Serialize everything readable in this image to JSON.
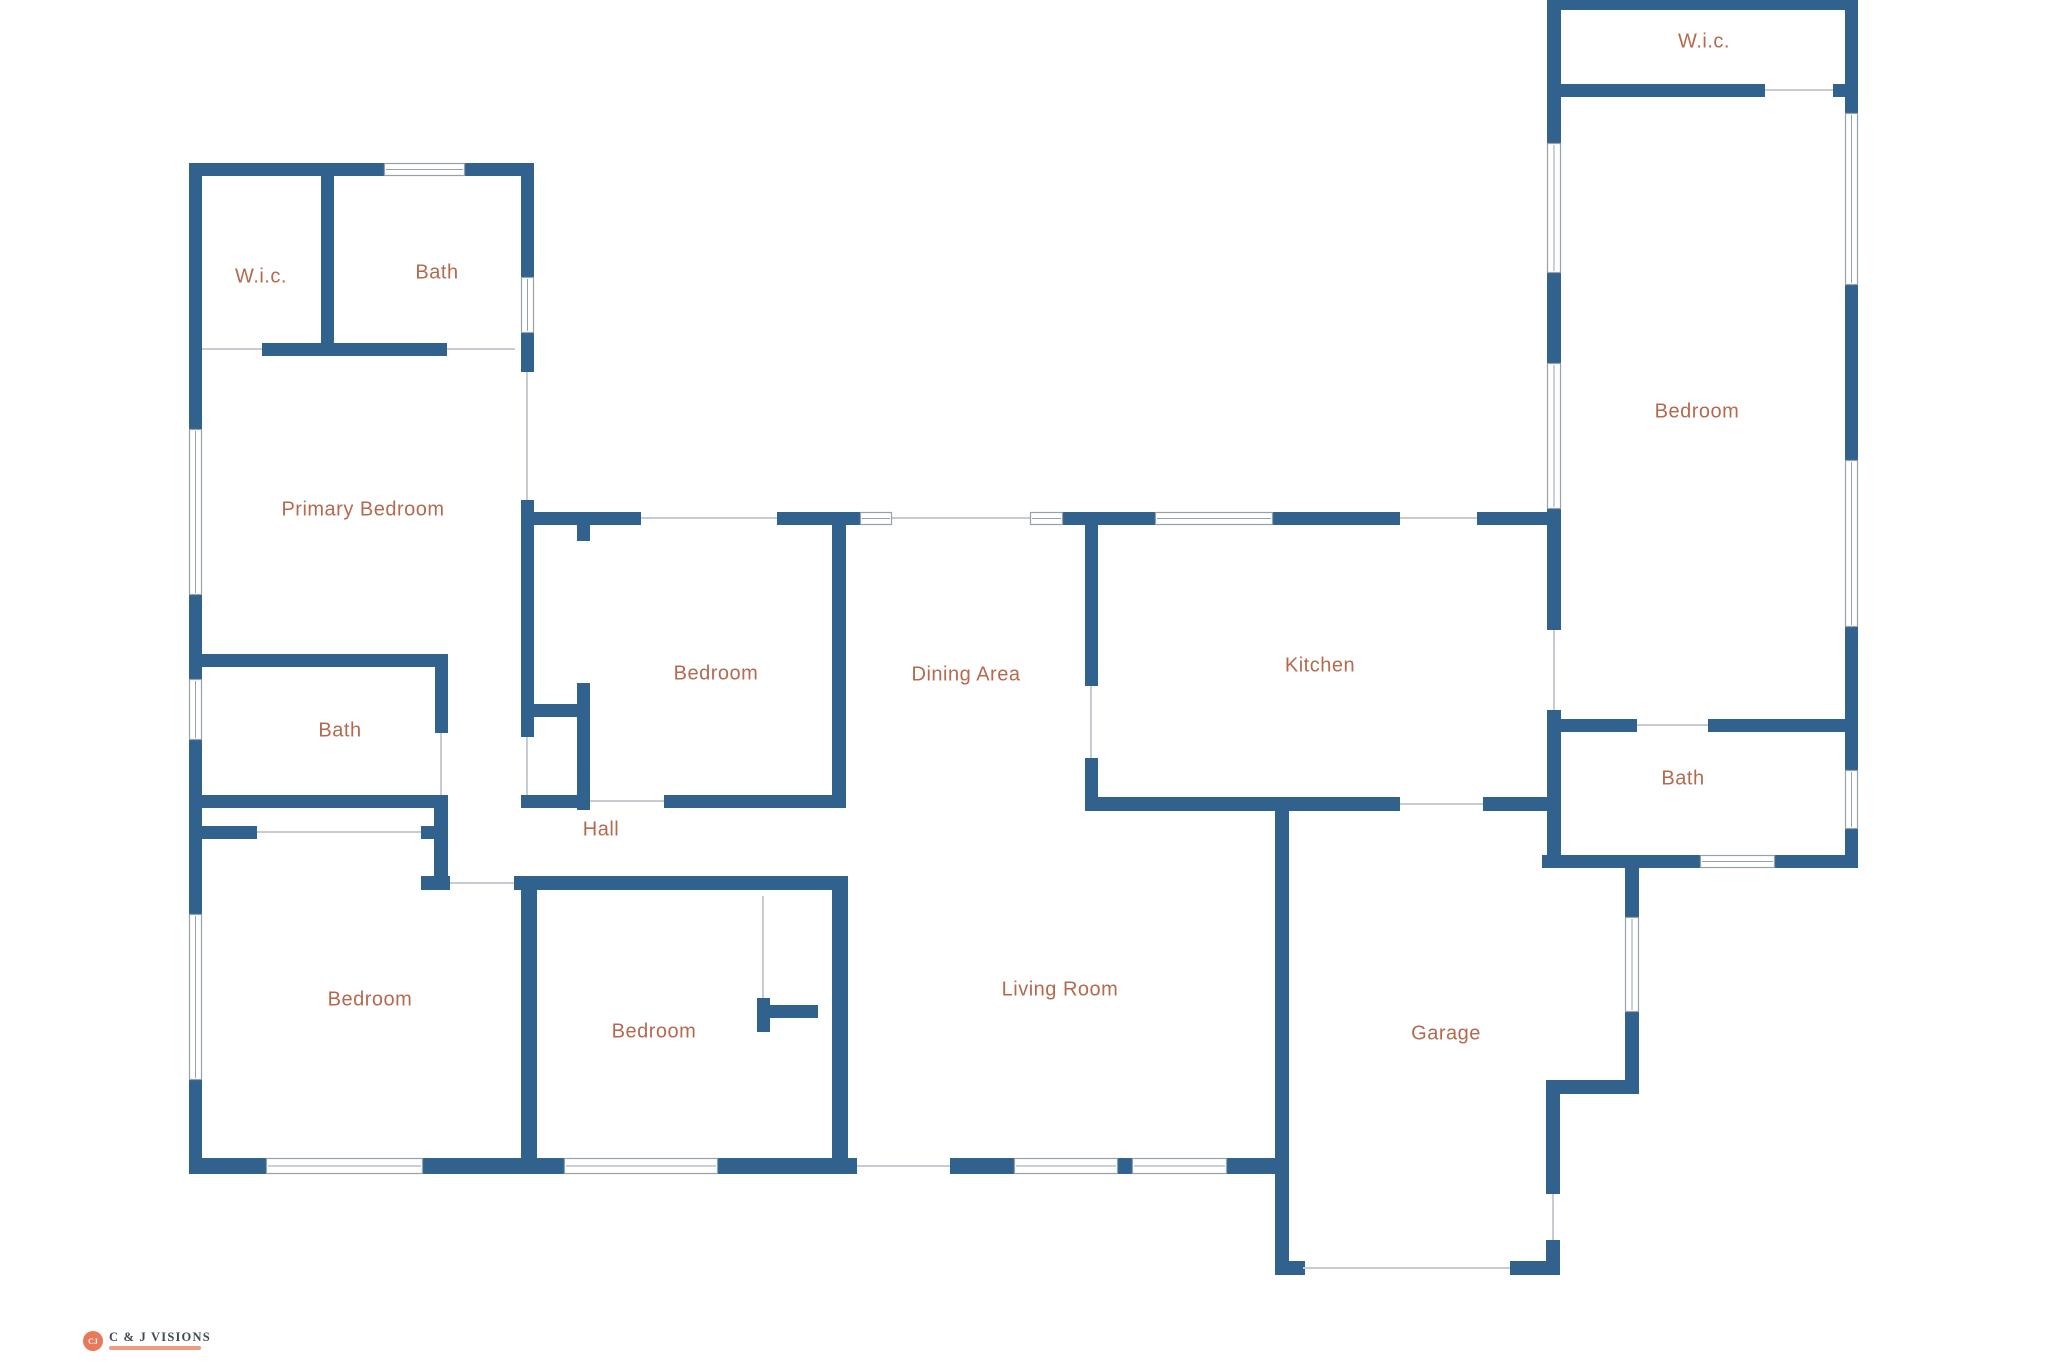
{
  "canvas": {
    "width": 2048,
    "height": 1365
  },
  "palette": {
    "background": "#ffffff",
    "wall": "#30628d",
    "label": "#b5694f",
    "opening_line": "#c6ccd2",
    "window_stroke": "#97a1aa",
    "window_fill": "#ffffff"
  },
  "rooms": [
    {
      "id": "wic-upper-left",
      "label": "W.i.c.",
      "x": 261,
      "y": 277
    },
    {
      "id": "bath-upper-left",
      "label": "Bath",
      "x": 437,
      "y": 273
    },
    {
      "id": "primary-bedroom",
      "label": "Primary Bedroom",
      "x": 363,
      "y": 510
    },
    {
      "id": "bath-left",
      "label": "Bath",
      "x": 340,
      "y": 731
    },
    {
      "id": "hall",
      "label": "Hall",
      "x": 601,
      "y": 830
    },
    {
      "id": "bedroom-mid",
      "label": "Bedroom",
      "x": 716,
      "y": 674
    },
    {
      "id": "dining-area",
      "label": "Dining Area",
      "x": 966,
      "y": 675
    },
    {
      "id": "kitchen",
      "label": "Kitchen",
      "x": 1320,
      "y": 666
    },
    {
      "id": "bedroom-bottom-left",
      "label": "Bedroom",
      "x": 370,
      "y": 1000
    },
    {
      "id": "bedroom-bottom-mid",
      "label": "Bedroom",
      "x": 654,
      "y": 1032
    },
    {
      "id": "living-room",
      "label": "Living Room",
      "x": 1060,
      "y": 990
    },
    {
      "id": "garage",
      "label": "Garage",
      "x": 1446,
      "y": 1034
    },
    {
      "id": "bath-right",
      "label": "Bath",
      "x": 1683,
      "y": 779
    },
    {
      "id": "wic-upper-right",
      "label": "W.i.c.",
      "x": 1704,
      "y": 42
    },
    {
      "id": "bedroom-right",
      "label": "Bedroom",
      "x": 1697,
      "y": 412
    }
  ],
  "walls": [
    {
      "x": 189,
      "y": 163,
      "w": 13,
      "h": 266
    },
    {
      "x": 189,
      "y": 595,
      "w": 13,
      "h": 84
    },
    {
      "x": 189,
      "y": 740,
      "w": 13,
      "h": 174
    },
    {
      "x": 189,
      "y": 1080,
      "w": 13,
      "h": 94
    },
    {
      "x": 189,
      "y": 163,
      "w": 195,
      "h": 13
    },
    {
      "x": 465,
      "y": 163,
      "w": 69,
      "h": 13
    },
    {
      "x": 321,
      "y": 176,
      "w": 13,
      "h": 167
    },
    {
      "x": 262,
      "y": 343,
      "w": 185,
      "h": 13
    },
    {
      "x": 521,
      "y": 176,
      "w": 13,
      "h": 101
    },
    {
      "x": 521,
      "y": 333,
      "w": 13,
      "h": 39
    },
    {
      "x": 521,
      "y": 500,
      "w": 13,
      "h": 237
    },
    {
      "x": 202,
      "y": 654,
      "w": 246,
      "h": 13
    },
    {
      "x": 435,
      "y": 667,
      "w": 13,
      "h": 66
    },
    {
      "x": 202,
      "y": 795,
      "w": 241,
      "h": 13
    },
    {
      "x": 202,
      "y": 826,
      "w": 55,
      "h": 13
    },
    {
      "x": 421,
      "y": 826,
      "w": 26,
      "h": 13
    },
    {
      "x": 434,
      "y": 795,
      "w": 14,
      "h": 81
    },
    {
      "x": 421,
      "y": 876,
      "w": 29,
      "h": 14
    },
    {
      "x": 514,
      "y": 876,
      "w": 30,
      "h": 14
    },
    {
      "x": 521,
      "y": 876,
      "w": 16,
      "h": 298
    },
    {
      "x": 537,
      "y": 876,
      "w": 309,
      "h": 14
    },
    {
      "x": 521,
      "y": 512,
      "w": 120,
      "h": 13
    },
    {
      "x": 777,
      "y": 512,
      "w": 84,
      "h": 13
    },
    {
      "x": 1063,
      "y": 512,
      "w": 92,
      "h": 13
    },
    {
      "x": 1273,
      "y": 512,
      "w": 127,
      "h": 13
    },
    {
      "x": 1477,
      "y": 512,
      "w": 79,
      "h": 13
    },
    {
      "x": 577,
      "y": 525,
      "w": 13,
      "h": 16
    },
    {
      "x": 534,
      "y": 704,
      "w": 43,
      "h": 13
    },
    {
      "x": 577,
      "y": 683,
      "w": 13,
      "h": 127
    },
    {
      "x": 832,
      "y": 525,
      "w": 14,
      "h": 283
    },
    {
      "x": 521,
      "y": 795,
      "w": 69,
      "h": 13
    },
    {
      "x": 664,
      "y": 795,
      "w": 182,
      "h": 13
    },
    {
      "x": 757,
      "y": 998,
      "w": 13,
      "h": 34
    },
    {
      "x": 770,
      "y": 1005,
      "w": 48,
      "h": 13
    },
    {
      "x": 832,
      "y": 876,
      "w": 16,
      "h": 298
    },
    {
      "x": 189,
      "y": 1158,
      "w": 77,
      "h": 16
    },
    {
      "x": 423,
      "y": 1158,
      "w": 141,
      "h": 16
    },
    {
      "x": 718,
      "y": 1158,
      "w": 139,
      "h": 16
    },
    {
      "x": 950,
      "y": 1158,
      "w": 64,
      "h": 16
    },
    {
      "x": 1118,
      "y": 1158,
      "w": 14,
      "h": 16
    },
    {
      "x": 1227,
      "y": 1158,
      "w": 48,
      "h": 16
    },
    {
      "x": 1085,
      "y": 525,
      "w": 13,
      "h": 161
    },
    {
      "x": 1085,
      "y": 758,
      "w": 13,
      "h": 50
    },
    {
      "x": 1085,
      "y": 797,
      "w": 315,
      "h": 14
    },
    {
      "x": 1483,
      "y": 797,
      "w": 73,
      "h": 14
    },
    {
      "x": 1275,
      "y": 810,
      "w": 14,
      "h": 465
    },
    {
      "x": 1289,
      "y": 1261,
      "w": 16,
      "h": 14
    },
    {
      "x": 1625,
      "y": 868,
      "w": 14,
      "h": 49
    },
    {
      "x": 1625,
      "y": 1012,
      "w": 14,
      "h": 82
    },
    {
      "x": 1546,
      "y": 1080,
      "w": 93,
      "h": 14
    },
    {
      "x": 1546,
      "y": 1094,
      "w": 14,
      "h": 100
    },
    {
      "x": 1510,
      "y": 1261,
      "w": 50,
      "h": 14
    },
    {
      "x": 1546,
      "y": 1240,
      "w": 14,
      "h": 21
    },
    {
      "x": 1547,
      "y": 0,
      "w": 311,
      "h": 10
    },
    {
      "x": 1547,
      "y": 0,
      "w": 14,
      "h": 143
    },
    {
      "x": 1547,
      "y": 273,
      "w": 14,
      "h": 90
    },
    {
      "x": 1547,
      "y": 509,
      "w": 14,
      "h": 121
    },
    {
      "x": 1547,
      "y": 710,
      "w": 14,
      "h": 158
    },
    {
      "x": 1547,
      "y": 84,
      "w": 218,
      "h": 13
    },
    {
      "x": 1833,
      "y": 84,
      "w": 25,
      "h": 13
    },
    {
      "x": 1845,
      "y": 0,
      "w": 13,
      "h": 113
    },
    {
      "x": 1845,
      "y": 285,
      "w": 13,
      "h": 175
    },
    {
      "x": 1845,
      "y": 627,
      "w": 13,
      "h": 143
    },
    {
      "x": 1845,
      "y": 829,
      "w": 13,
      "h": 39
    },
    {
      "x": 1561,
      "y": 719,
      "w": 76,
      "h": 13
    },
    {
      "x": 1708,
      "y": 719,
      "w": 140,
      "h": 13
    },
    {
      "x": 1542,
      "y": 855,
      "w": 158,
      "h": 13
    },
    {
      "x": 1775,
      "y": 855,
      "w": 83,
      "h": 13
    }
  ],
  "windows": [
    {
      "x": 189,
      "y": 429,
      "w": 13,
      "h": 166
    },
    {
      "x": 189,
      "y": 679,
      "w": 13,
      "h": 61
    },
    {
      "x": 189,
      "y": 914,
      "w": 13,
      "h": 166
    },
    {
      "x": 384,
      "y": 163,
      "w": 81,
      "h": 13
    },
    {
      "x": 521,
      "y": 277,
      "w": 13,
      "h": 56
    },
    {
      "x": 266,
      "y": 1158,
      "w": 157,
      "h": 16
    },
    {
      "x": 564,
      "y": 1158,
      "w": 154,
      "h": 16
    },
    {
      "x": 1014,
      "y": 1158,
      "w": 104,
      "h": 16
    },
    {
      "x": 1132,
      "y": 1158,
      "w": 95,
      "h": 16
    },
    {
      "x": 860,
      "y": 512,
      "w": 32,
      "h": 13
    },
    {
      "x": 1030,
      "y": 512,
      "w": 33,
      "h": 13
    },
    {
      "x": 1155,
      "y": 512,
      "w": 118,
      "h": 13
    },
    {
      "x": 1700,
      "y": 855,
      "w": 75,
      "h": 13
    },
    {
      "x": 1625,
      "y": 917,
      "w": 14,
      "h": 95
    },
    {
      "x": 1547,
      "y": 143,
      "w": 14,
      "h": 130
    },
    {
      "x": 1547,
      "y": 363,
      "w": 14,
      "h": 146
    },
    {
      "x": 1845,
      "y": 113,
      "w": 13,
      "h": 172
    },
    {
      "x": 1845,
      "y": 460,
      "w": 13,
      "h": 167
    },
    {
      "x": 1845,
      "y": 770,
      "w": 13,
      "h": 59
    }
  ],
  "openings": [
    {
      "x1": 202,
      "y1": 349,
      "x2": 262,
      "y2": 349
    },
    {
      "x1": 447,
      "y1": 349,
      "x2": 515,
      "y2": 349
    },
    {
      "x1": 527,
      "y1": 372,
      "x2": 527,
      "y2": 500
    },
    {
      "x1": 527,
      "y1": 737,
      "x2": 527,
      "y2": 795
    },
    {
      "x1": 441,
      "y1": 733,
      "x2": 441,
      "y2": 795
    },
    {
      "x1": 257,
      "y1": 832,
      "x2": 421,
      "y2": 832
    },
    {
      "x1": 450,
      "y1": 883,
      "x2": 514,
      "y2": 883
    },
    {
      "x1": 590,
      "y1": 801,
      "x2": 664,
      "y2": 801
    },
    {
      "x1": 641,
      "y1": 518,
      "x2": 777,
      "y2": 518
    },
    {
      "x1": 892,
      "y1": 518,
      "x2": 1030,
      "y2": 518
    },
    {
      "x1": 1400,
      "y1": 518,
      "x2": 1477,
      "y2": 518
    },
    {
      "x1": 1091,
      "y1": 686,
      "x2": 1091,
      "y2": 758
    },
    {
      "x1": 1400,
      "y1": 804,
      "x2": 1483,
      "y2": 804
    },
    {
      "x1": 857,
      "y1": 1166,
      "x2": 950,
      "y2": 1166
    },
    {
      "x1": 1554,
      "y1": 630,
      "x2": 1554,
      "y2": 710
    },
    {
      "x1": 1765,
      "y1": 90,
      "x2": 1833,
      "y2": 90
    },
    {
      "x1": 1637,
      "y1": 725,
      "x2": 1708,
      "y2": 725
    },
    {
      "x1": 1553,
      "y1": 1194,
      "x2": 1553,
      "y2": 1240
    },
    {
      "x1": 1303,
      "y1": 1268,
      "x2": 1510,
      "y2": 1268
    },
    {
      "x1": 763,
      "y1": 896,
      "x2": 763,
      "y2": 998
    }
  ],
  "logo": {
    "monogram": "CJ",
    "text": "C & J VISIONS",
    "accent": "#e8795b"
  }
}
